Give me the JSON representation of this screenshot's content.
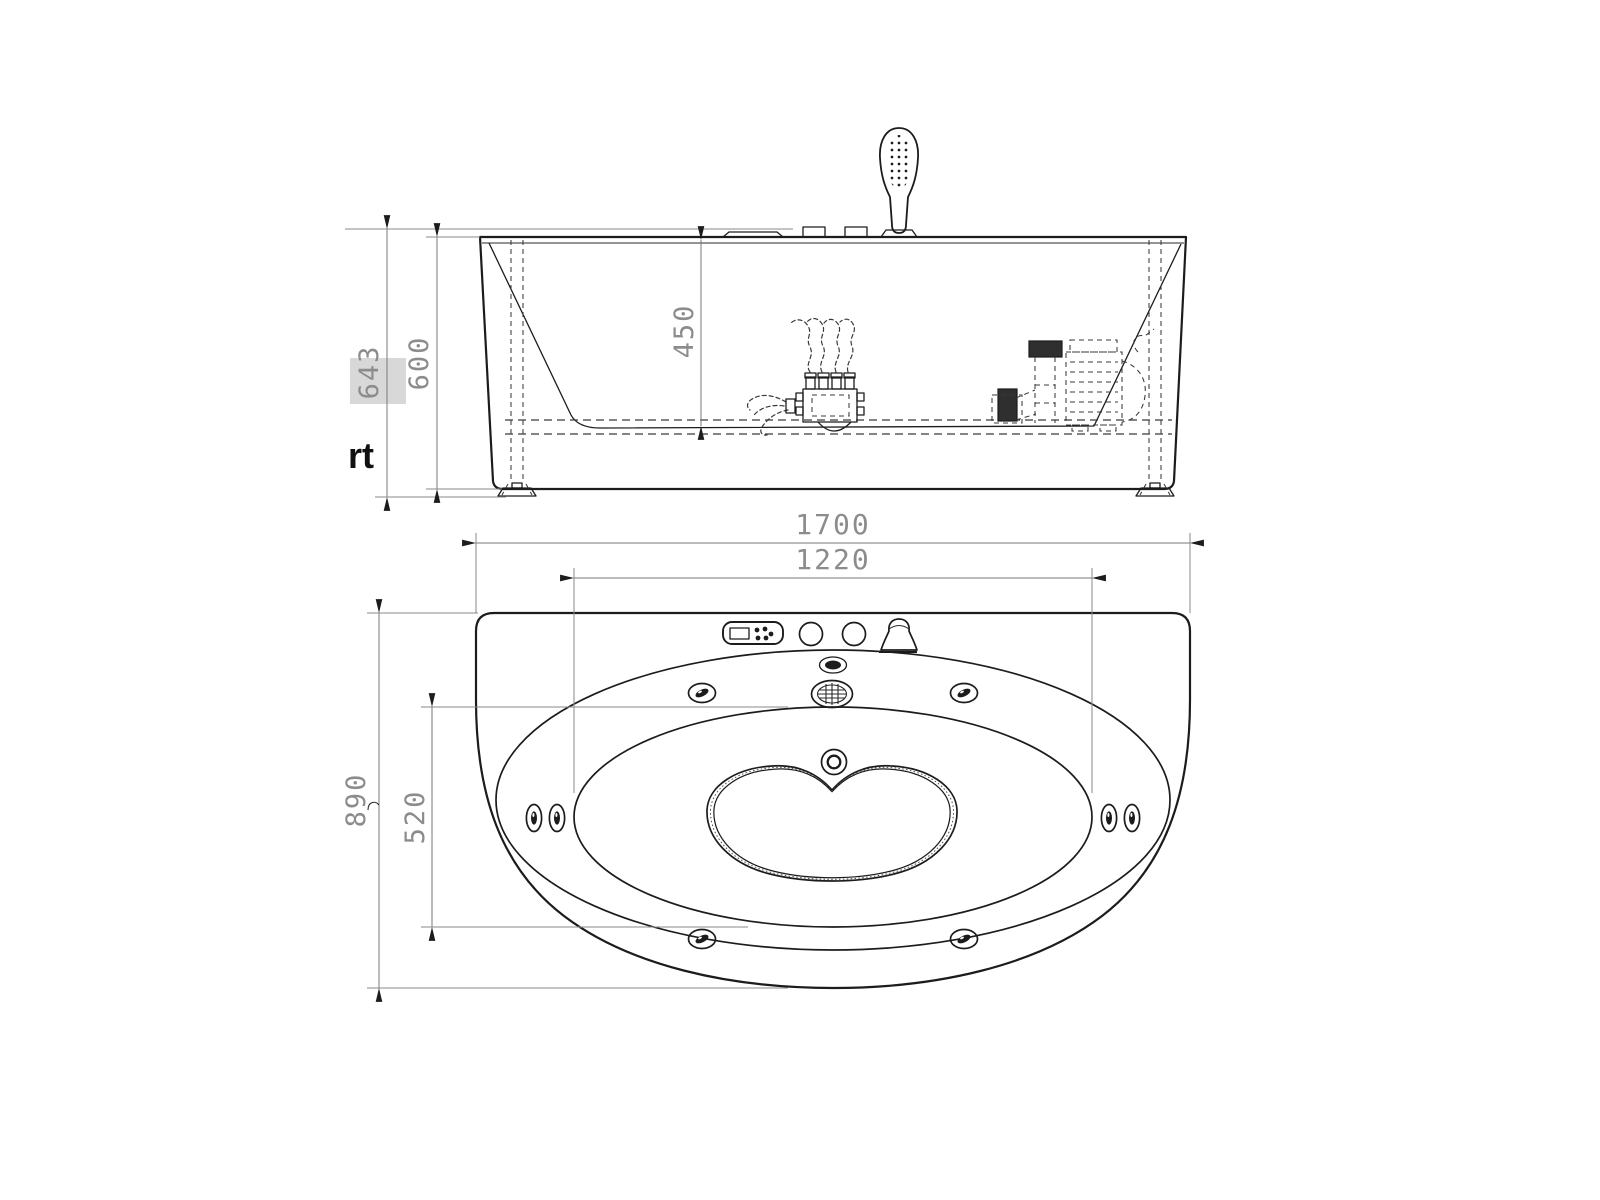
{
  "page": {
    "background": "#ffffff",
    "kind": "bathtub-installation-technical-drawing"
  },
  "colors": {
    "line": "#1c1c1c",
    "dim_line": "#7a7a7a",
    "dim_text": "#8c8c8c",
    "highlight_box": "#d8d8d8",
    "watermark_text": "#101010"
  },
  "elevation_view": {
    "name": "front-elevation-section",
    "dims": {
      "total_height": "643",
      "body_height": "600",
      "inner_depth": "450"
    },
    "watermark": "rt",
    "parts": [
      "hand-shower",
      "deck-button",
      "deck-control-panel",
      "air-control-manifold",
      "air-flow-lines",
      "water-pump",
      "support-leg",
      "frame-rail",
      "adjustable-foot"
    ]
  },
  "plan_view": {
    "name": "top-plan",
    "dims": {
      "overall_length": "1700",
      "basin_length": "1220",
      "basin_width": "520",
      "overall_width": "890"
    },
    "parts": [
      "control-panel",
      "display-window",
      "panel-button",
      "temperature-knob",
      "faucet-spout",
      "overflow-cover",
      "suction-grille",
      "drain-cap",
      "hydro-jet",
      "side-jet",
      "seat-contour"
    ]
  }
}
